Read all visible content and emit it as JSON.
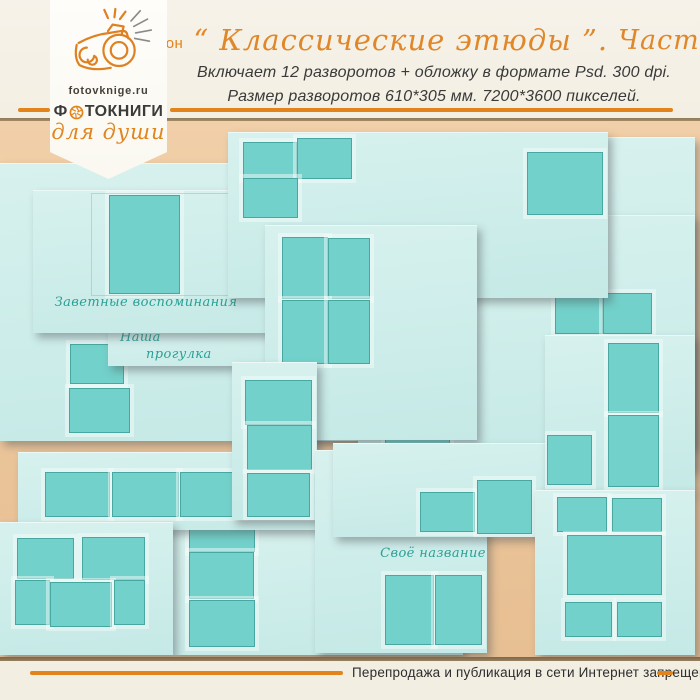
{
  "page": {
    "width": 700,
    "height": 700
  },
  "colors": {
    "accent_orange": "#e2831c",
    "header_cream": "#f4f0e6",
    "footer_cream": "#f2eee2",
    "backdrop_tan": "#ecc69c",
    "page_cyan": "#cfeeeb",
    "photo_teal": "#72d1ca",
    "caption_teal": "#2aa095",
    "text_dark": "#3a3a3a",
    "separator_brown": "#8d7758"
  },
  "badge": {
    "site": "fotovknige.ru",
    "brand_first_letter": "Ф",
    "brand_rest": "ТОКНИГИ",
    "tagline": "для души",
    "icons": [
      "camera-doodle-icon",
      "aperture-o-icon"
    ]
  },
  "header": {
    "title_label": "Шаблон",
    "title_script": "“ Классические этюды ”.",
    "title_part": "Часть 3",
    "subtitle_line1": "Включает 12 разворотов + обложку в формате Psd. 300 dpi.",
    "subtitle_line2": "Размер разворотов  610*305 мм.  7200*3600 пикселей."
  },
  "collage": {
    "spreads": [
      {
        "name": "base-left",
        "x": 0,
        "y": 163,
        "w": 465,
        "h": 278,
        "boxes": [
          [
            70,
            181,
            52,
            38
          ],
          [
            69,
            225,
            59,
            43
          ]
        ]
      },
      {
        "name": "back-right",
        "x": 607,
        "y": 137,
        "w": 88,
        "h": 310,
        "boxes": []
      },
      {
        "name": "mid-right",
        "x": 358,
        "y": 215,
        "w": 337,
        "h": 255,
        "boxes": [
          [
            27,
            85,
            65,
            44
          ],
          [
            27,
            133,
            62,
            44
          ],
          [
            27,
            181,
            63,
            46
          ],
          [
            197,
            78,
            46,
            39
          ],
          [
            245,
            78,
            47,
            39
          ]
        ]
      },
      {
        "name": "spread-nasha-progulka",
        "x": 108,
        "y": 326,
        "w": 358,
        "h": 40,
        "caption": {
          "lines": [
            "Наша",
            "прогулка"
          ],
          "x": 12,
          "y": 4,
          "indent": 26
        }
      },
      {
        "name": "cover-zavetnye",
        "x": 33,
        "y": 190,
        "w": 424,
        "h": 143,
        "boxes": [
          [
            76,
            5,
            69,
            97
          ]
        ],
        "frame": [
          58,
          3,
          334,
          101
        ],
        "caption": {
          "lines": [
            "Заветные воспоминания"
          ],
          "x": 0,
          "y": 105,
          "w": 226
        }
      },
      {
        "name": "top-right",
        "x": 228,
        "y": 132,
        "w": 380,
        "h": 166,
        "boxes": [
          [
            15,
            10,
            52,
            35
          ],
          [
            69,
            6,
            53,
            39
          ],
          [
            15,
            46,
            53,
            38
          ],
          [
            299,
            20,
            74,
            61
          ]
        ]
      },
      {
        "name": "grid-2x2",
        "x": 265,
        "y": 225,
        "w": 212,
        "h": 215,
        "boxes": [
          [
            17,
            12,
            44,
            60
          ],
          [
            63,
            13,
            40,
            59
          ],
          [
            17,
            75,
            44,
            62
          ],
          [
            63,
            75,
            40,
            62
          ]
        ]
      },
      {
        "name": "bottom-mid",
        "x": 173,
        "y": 528,
        "w": 290,
        "h": 127,
        "boxes": [
          [
            16,
            -6,
            64,
            28
          ],
          [
            16,
            24,
            63,
            45
          ],
          [
            16,
            72,
            64,
            45
          ]
        ]
      },
      {
        "name": "row-strip",
        "x": 18,
        "y": 452,
        "w": 445,
        "h": 78,
        "boxes": [
          [
            27,
            20,
            63,
            43
          ],
          [
            94,
            20,
            65,
            43
          ],
          [
            162,
            20,
            62,
            43
          ],
          [
            229,
            20,
            63,
            43
          ]
        ]
      },
      {
        "name": "col3-mid",
        "x": 232,
        "y": 362,
        "w": 85,
        "h": 158,
        "boxes": [
          [
            13,
            18,
            65,
            43
          ],
          [
            15,
            63,
            63,
            43
          ],
          [
            15,
            111,
            61,
            42
          ]
        ]
      },
      {
        "name": "cover-svoe-nazvanie",
        "x": 315,
        "y": 450,
        "w": 172,
        "h": 203,
        "boxes": [
          [
            70,
            125,
            47,
            68
          ],
          [
            120,
            125,
            45,
            68
          ]
        ],
        "caption": {
          "lines": [
            "Своё название"
          ],
          "x": 18,
          "y": 96,
          "w": 200
        }
      },
      {
        "name": "mid-bottom",
        "x": 333,
        "y": 443,
        "w": 212,
        "h": 94,
        "boxes": [
          [
            87,
            49,
            53,
            38
          ],
          [
            144,
            37,
            53,
            52
          ]
        ]
      },
      {
        "name": "col2-right",
        "x": 545,
        "y": 335,
        "w": 150,
        "h": 158,
        "boxes": [
          [
            63,
            8,
            49,
            68
          ],
          [
            63,
            80,
            49,
            70
          ],
          [
            2,
            100,
            43,
            48
          ]
        ]
      },
      {
        "name": "bottom-left",
        "x": 0,
        "y": 522,
        "w": 173,
        "h": 133,
        "boxes": [
          [
            17,
            16,
            55,
            39
          ],
          [
            82,
            15,
            61,
            41
          ],
          [
            15,
            58,
            33,
            43
          ],
          [
            50,
            60,
            60,
            43
          ],
          [
            114,
            58,
            29,
            43
          ]
        ]
      },
      {
        "name": "bottom-right-cover",
        "x": 535,
        "y": 490,
        "w": 160,
        "h": 165,
        "boxes": [
          [
            22,
            7,
            48,
            33
          ],
          [
            77,
            8,
            48,
            32
          ],
          [
            32,
            45,
            93,
            58
          ],
          [
            30,
            112,
            45,
            33
          ],
          [
            82,
            112,
            43,
            33
          ]
        ]
      }
    ]
  },
  "footer": {
    "notice": "Перепродажа и публикация в сети Интернет запрещены!"
  }
}
